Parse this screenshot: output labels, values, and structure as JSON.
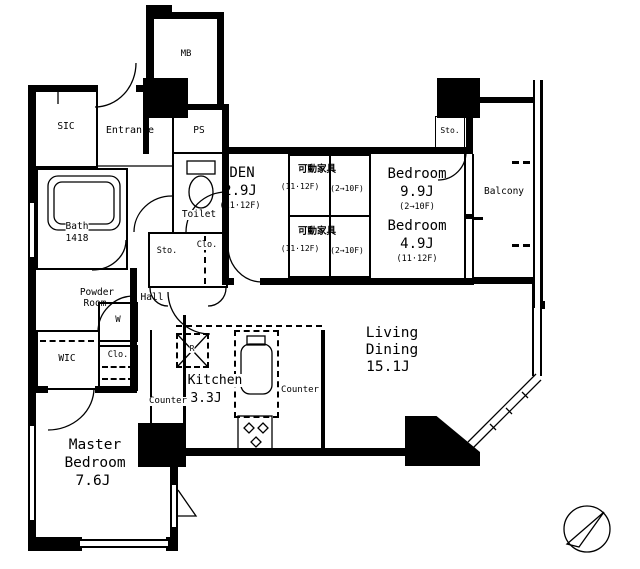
{
  "meta": {
    "type": "apartment-floor-plan",
    "bg": "#ffffff",
    "ink": "#000000"
  },
  "labels": {
    "mb": "MB",
    "entrance": "Entrance",
    "ps": "PS",
    "sic": "SIC",
    "toilet": "Toilet",
    "bath_name": "Bath",
    "bath_size": "1418",
    "den_name": "DEN",
    "den_area": "2.9J",
    "den_floors": "(11·12F)",
    "movable_name": "可動家具",
    "movable_floors_a": "(11·12F)",
    "movable_floors_b": "(2→10F)",
    "bedroom_a_name": "Bedroom",
    "bedroom_a_area": "9.9J",
    "bedroom_a_floors": "(2→10F)",
    "bedroom_b_name": "Bedroom",
    "bedroom_b_area": "4.9J",
    "bedroom_b_floors": "(11·12F)",
    "sto_upper": "Sto.",
    "balcony": "Balcony",
    "sto_mid": "Sto.",
    "clo_mid": "Clo.",
    "hall": "Hall",
    "powder_1": "Powder",
    "powder_2": "Room",
    "washer": "W",
    "wic": "WIC",
    "clo_left": "Clo.",
    "counter_left": "Counter",
    "counter_right": "Counter",
    "kitchen_name": "Kitchen",
    "kitchen_area": "3.3J",
    "fridge": "R",
    "living_1": "Living",
    "living_2": "Dining",
    "living_area": "15.1J",
    "master_1": "Master",
    "master_2": "Bedroom",
    "master_area": "7.6J"
  }
}
